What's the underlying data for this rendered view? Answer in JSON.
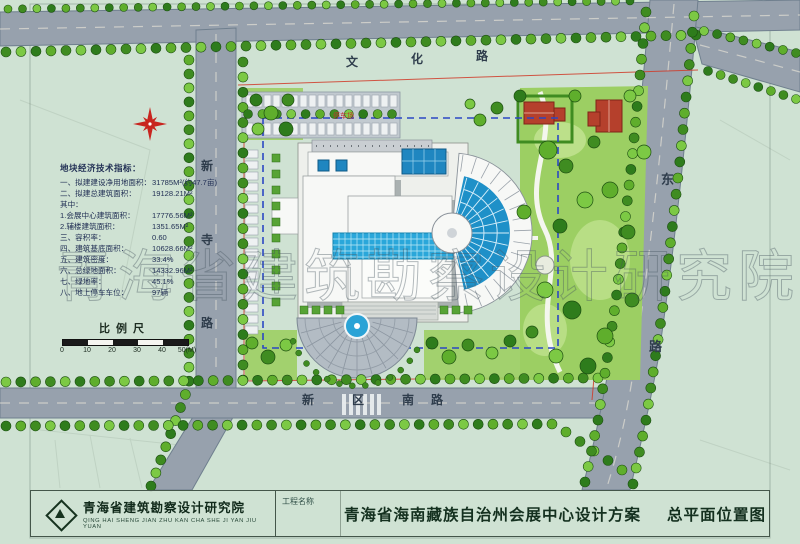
{
  "plan": {
    "watermark": "青海省建筑勘察设计研究院",
    "roads": {
      "north": {
        "name": "文化路",
        "chars": [
          "文",
          "化",
          "路"
        ]
      },
      "west": {
        "name": "新寺路",
        "chars": [
          "新",
          "寺",
          "路"
        ]
      },
      "south": {
        "name": "新区南路",
        "chars": [
          "新",
          "区",
          "南",
          "路"
        ]
      },
      "east": {
        "name": "东路",
        "chars": [
          "东",
          "路"
        ]
      }
    },
    "labels": {
      "parking": "停车场"
    },
    "indicators": {
      "title": "地块经济技术指标：",
      "lines": [
        {
          "label": "一、拟建建设净用地面积：",
          "value": "31785M²(约47.7亩)"
        },
        {
          "label": "二、拟建总建筑面积：",
          "value": "19128.21M²"
        },
        {
          "label": "其中：",
          "value": ""
        },
        {
          "label": "1.会展中心建筑面积：",
          "value": "17776.56M²"
        },
        {
          "label": "2.辅楼建筑面积：",
          "value": "1351.65M²"
        },
        {
          "label": "三、容积率：",
          "value": "0.60"
        },
        {
          "label": "四、建筑基底面积：",
          "value": "10628.66M²"
        },
        {
          "label": "五、建筑密度：",
          "value": "33.4%"
        },
        {
          "label": "六、总绿地面积：",
          "value": "14332.96M²"
        },
        {
          "label": "七、绿地率：",
          "value": "45.1%"
        },
        {
          "label": "八、地上停车车位：",
          "value": "97辆"
        }
      ]
    },
    "scale": {
      "title": "比例尺",
      "ticks": [
        "0",
        "10",
        "20",
        "30",
        "40",
        "50(M)"
      ]
    }
  },
  "titleblock": {
    "institute": "青海省建筑勘察设计研究院",
    "institute_pinyin": "QING HAI SHENG JIAN ZHU KAN CHA SHE JI YAN JIU YUAN",
    "project_label": "工程名称",
    "project_name": "青海省海南藏族自治州会展中心设计方案",
    "drawing_name": "总平面位置图"
  },
  "colors": {
    "paper": "#cfe2d3",
    "road": "#97a1ad",
    "road_edge": "#6f7f8e",
    "water": "#2aa7da",
    "roof_red": "#b5402c",
    "lawn": "#9ccf63",
    "lawn_light": "#c4e494",
    "tree_palette": [
      "#5fae2c",
      "#3f8c21",
      "#7cc944",
      "#2e7c1c"
    ],
    "tree_stroke": "#1d4f12",
    "boundary_dash": "#2b47c4",
    "red_line": "#d03a28",
    "building_white": "#f7f8f6",
    "plaza": "#b3bcc4",
    "ink": "#223055"
  }
}
